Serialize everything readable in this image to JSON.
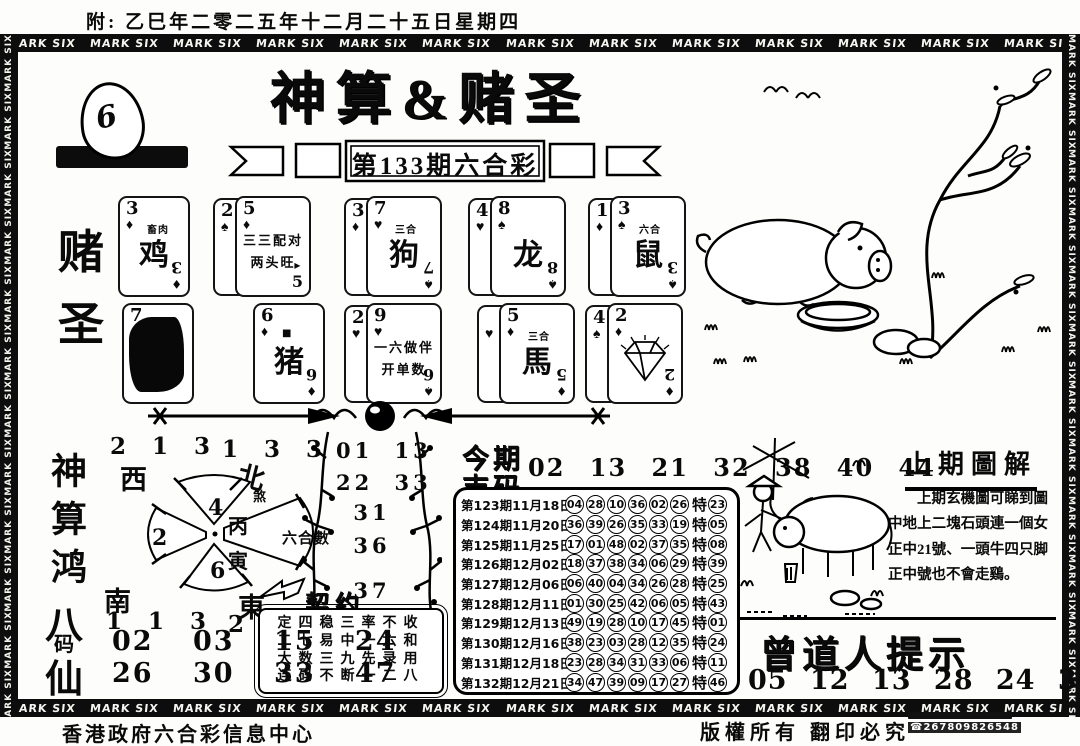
{
  "page": {
    "top_note": "附: 乙巳年二零二五年十二月二十五日星期四",
    "border_label": "MARK SIX",
    "title": "神算&赌圣",
    "issue_banner": "第133期六合彩",
    "logo_number": "6"
  },
  "left_labels": {
    "gambler_char1": "赌",
    "gambler_char2": "圣",
    "column_mid": "神算鸿",
    "bama_top": "八",
    "bama_mid": "码",
    "bama_bottom": "仙"
  },
  "cards": {
    "groups": [
      {
        "x": 118,
        "y": 196,
        "front": {
          "rank": "3",
          "suit": "♦",
          "note": "畜肉",
          "center": "鸡",
          "bottom": "3",
          "bottom_suit": "♦"
        }
      },
      {
        "x": 213,
        "y": 196,
        "back": {
          "rank": "2",
          "suit": "♠"
        },
        "front": {
          "rank": "5",
          "suit": "♦",
          "lines": [
            "三三配对",
            "两头旺"
          ],
          "bottom": "5",
          "bottom_suit": "▸",
          "bottom_upright": true
        }
      },
      {
        "x": 344,
        "y": 196,
        "back": {
          "rank": "3",
          "suit": "♦"
        },
        "front": {
          "rank": "7",
          "suit": "♥",
          "note": "三合",
          "center": "狗",
          "bottom": "7",
          "bottom_suit": "♠"
        }
      },
      {
        "x": 468,
        "y": 196,
        "back": {
          "rank": "4",
          "suit": "♥"
        },
        "front": {
          "rank": "8",
          "suit": "♠",
          "center": "龙",
          "bottom": "8",
          "bottom_suit": "♠"
        }
      },
      {
        "x": 588,
        "y": 196,
        "back": {
          "rank": "1",
          "suit": "♦"
        },
        "front": {
          "rank": "3",
          "suit": "♠",
          "note": "六合",
          "center": "鼠",
          "bottom": "3",
          "bottom_suit": "♠"
        }
      },
      {
        "x": 122,
        "y": 303,
        "front": {
          "rank": "7",
          "suit": "",
          "blob": true
        }
      },
      {
        "x": 253,
        "y": 303,
        "front": {
          "rank": "6",
          "suit": "♦",
          "note": "■",
          "center": "猪",
          "bottom": "6",
          "bottom_suit": "♦"
        }
      },
      {
        "x": 344,
        "y": 303,
        "back": {
          "rank": "2",
          "suit": "♥"
        },
        "front": {
          "rank": "9",
          "suit": "♥",
          "lines": [
            "一六做伴",
            "开单数"
          ],
          "bottom": "6",
          "bottom_suit": "♠"
        }
      },
      {
        "x": 477,
        "y": 303,
        "back": {
          "rank": "",
          "suit": "♥"
        },
        "front": {
          "rank": "5",
          "suit": "♦",
          "note": "三合",
          "center": "馬",
          "bottom": "5",
          "bottom_suit": "♦"
        }
      },
      {
        "x": 585,
        "y": 303,
        "back": {
          "rank": "4",
          "suit": "♠"
        },
        "front": {
          "rank": "2",
          "suit": "♦",
          "diamond": true,
          "bottom": "2",
          "bottom_suit": "♦"
        }
      }
    ]
  },
  "compass": {
    "tl_nums": "2 1 3",
    "tl_dir": "西",
    "tr_nums": "1 3 3",
    "tr_dir": "北",
    "tr_small": "煞",
    "bl_dir": "南",
    "bl_nums": "1 1 3",
    "br_dir": "東",
    "br_nums": "2 2 1",
    "petal_top": "4",
    "petal_left": "2",
    "petal_bottom": "6",
    "petal_right": "六合數",
    "center_top": "丙",
    "center_bottom": "寅"
  },
  "plum": {
    "rows": [
      "01 13",
      "22 33",
      "31",
      "36",
      "37",
      "40"
    ]
  },
  "contract": {
    "label": "契约",
    "lines": [
      "定四稳三率不收",
      "二七易中一六和",
      "大数三九先录用",
      "连码不断一二八"
    ]
  },
  "lucky": {
    "label_line1": "今期",
    "label_line2": "吉码",
    "numbers": "02 13 21 32 38 40 44"
  },
  "results": {
    "te_label": "特",
    "rows": [
      {
        "period": "第123期11月18日",
        "nums": [
          "04",
          "28",
          "10",
          "36",
          "02",
          "26"
        ],
        "special": "23"
      },
      {
        "period": "第124期11月20日",
        "nums": [
          "36",
          "39",
          "26",
          "35",
          "33",
          "19"
        ],
        "special": "05"
      },
      {
        "period": "第125期11月25日",
        "nums": [
          "17",
          "01",
          "48",
          "02",
          "37",
          "35"
        ],
        "special": "08"
      },
      {
        "period": "第126期12月02日",
        "nums": [
          "18",
          "37",
          "38",
          "34",
          "06",
          "29"
        ],
        "special": "39"
      },
      {
        "period": "第127期12月06日",
        "nums": [
          "06",
          "40",
          "04",
          "34",
          "26",
          "28"
        ],
        "special": "25"
      },
      {
        "period": "第128期12月11日",
        "nums": [
          "01",
          "30",
          "25",
          "42",
          "06",
          "05"
        ],
        "special": "43"
      },
      {
        "period": "第129期12月13日",
        "nums": [
          "49",
          "19",
          "28",
          "10",
          "17",
          "45"
        ],
        "special": "01"
      },
      {
        "period": "第130期12月16日",
        "nums": [
          "38",
          "23",
          "03",
          "28",
          "12",
          "35"
        ],
        "special": "24"
      },
      {
        "period": "第131期12月18日",
        "nums": [
          "23",
          "28",
          "34",
          "31",
          "33",
          "06"
        ],
        "special": "11"
      },
      {
        "period": "第132期12月21日",
        "nums": [
          "34",
          "47",
          "39",
          "09",
          "17",
          "27"
        ],
        "special": "46"
      }
    ]
  },
  "bamao": {
    "row1": "02 03 15 24",
    "row2": "26 30 33 47"
  },
  "right_panel": {
    "title": "上期圖解",
    "paragraph": "上期玄機圖可睇到圖中地上二塊石頭連一個女正中21號、一頭牛四只脚正中號也不會走鷄。",
    "tips_title": "曾道人提示",
    "tips_numbers": "05 12 13 28 24 30 46"
  },
  "footer": {
    "center": "香港政府六合彩信息中心",
    "copyright": "版權所有 翻印必究",
    "phone": "☎267809826548"
  }
}
